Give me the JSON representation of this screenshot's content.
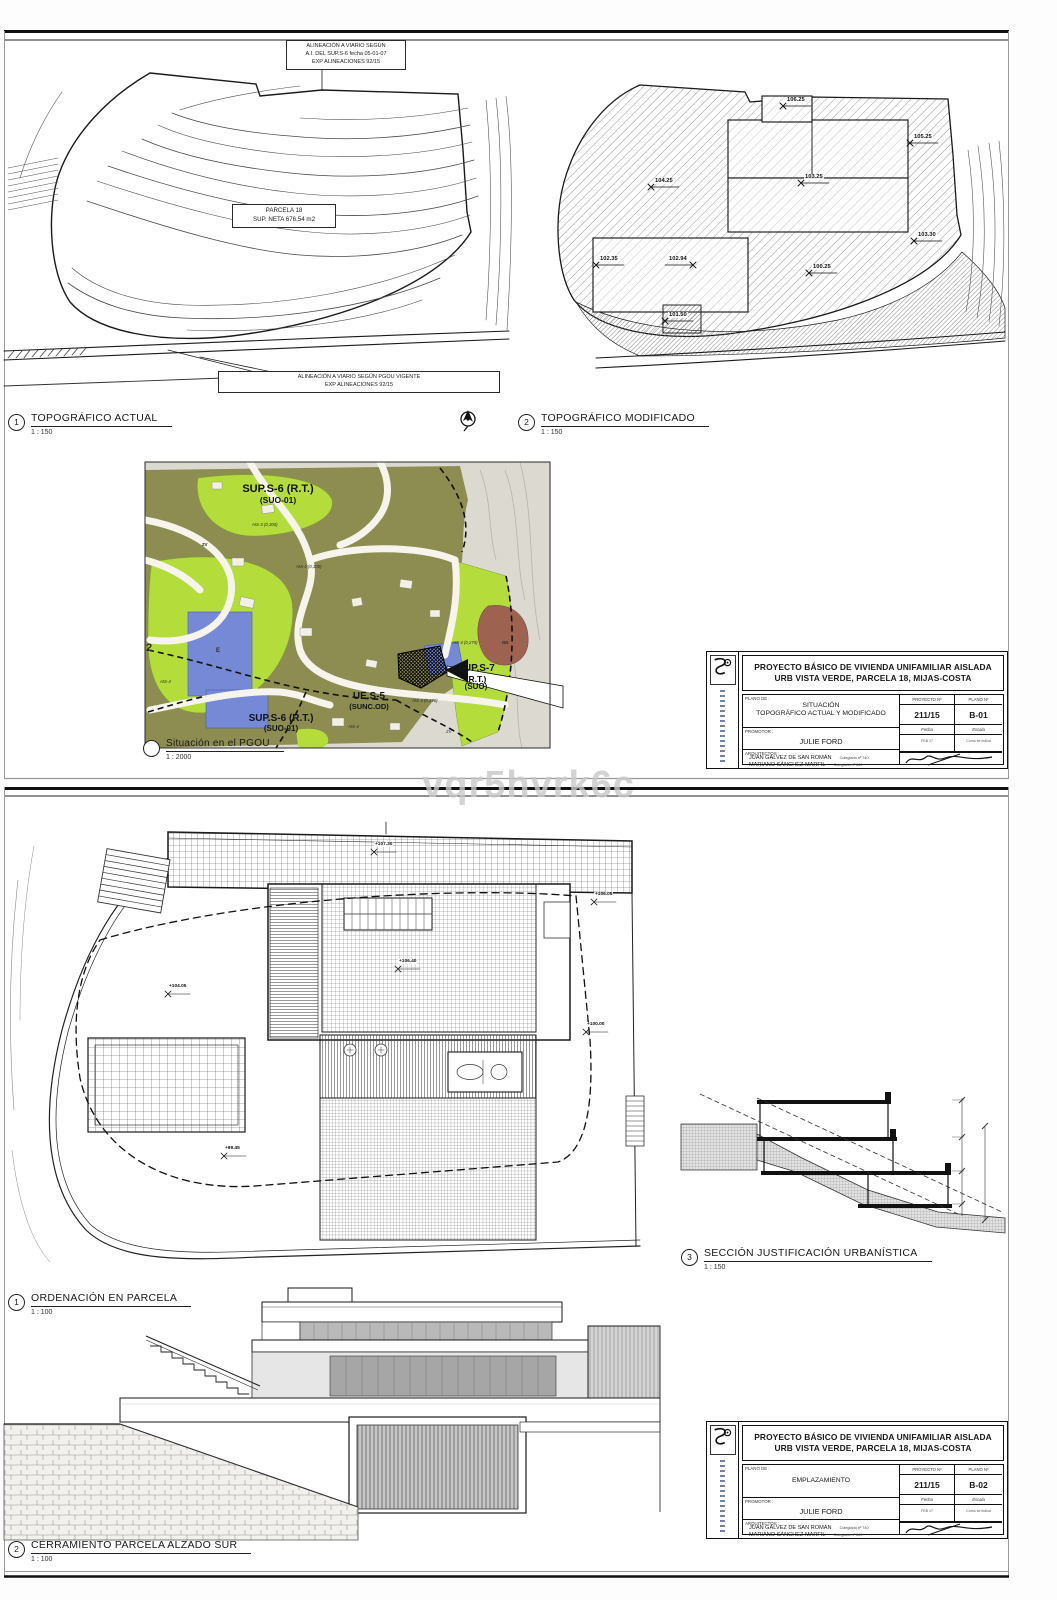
{
  "watermark": "vqr5hvrk6c",
  "common": {
    "project_title_1": "PROYECTO BÁSICO DE VIVIENDA UNIFAMILIAR AISLADA",
    "project_title_2": "URB VISTA VERDE, PARCELA 18, MIJAS-COSTA",
    "labels": {
      "plano_de": "PLANO DE :",
      "proyecto_n": "PROYECTO Nº",
      "plano_n": "PLANO Nº",
      "promotor": "PROMOTOR :",
      "fecha": "Fecha",
      "escala": "Escala",
      "arquitectos": "ARQUITECTOS :"
    },
    "proyecto_n_value": "211/15",
    "promotor_value": "JULIE FORD",
    "fecha_value": "FEB 17",
    "escala_value": "Como se indica",
    "arquitecto_1": "JUAN GÁLVEZ DE SAN ROMÁN",
    "arquitecto_1_col": "Colegiado nº 740",
    "arquitecto_2": "MARIANO SÁNCHEZ MARFIL",
    "arquitecto_2_col": "Colegiado nº 669"
  },
  "sheet1": {
    "titleblock": {
      "plano_value_1": "SITUACIÓN",
      "plano_value_2": "TOPOGRÁFICO ACTUAL Y MODIFICADO",
      "plano_n_value": "B-01"
    },
    "topo_actual": {
      "num": "1",
      "title": "TOPOGRÁFICO ACTUAL",
      "scale": "1 : 150",
      "note_top_1": "ALINEACIÓN A VIARIO SEGÚN",
      "note_top_2": "A.I. DEL SUP.S-6 fecha 05-01-07",
      "note_top_3": "EXP ALINEACIONES 92/15",
      "parcel_1": "PARCELA 18",
      "parcel_2": "SUP. NETA 676,54 m2",
      "note_bottom_1": "ALINEACIÓN A VIARIO SEGÚN PGOU VIGENTE",
      "note_bottom_2": "EXP ALINEACIONES 92/15"
    },
    "topo_mod": {
      "num": "2",
      "title": "TOPOGRÁFICO MODIFICADO",
      "scale": "1 : 150",
      "spots": [
        {
          "v": "106.25"
        },
        {
          "v": "105.25"
        },
        {
          "v": "104.25"
        },
        {
          "v": "103.25"
        },
        {
          "v": "103.30"
        },
        {
          "v": "102.35"
        },
        {
          "v": "102.94"
        },
        {
          "v": "100.25"
        },
        {
          "v": "101.50"
        }
      ]
    },
    "pgou": {
      "num": "",
      "title": "Situación en el PGOU",
      "scale": "1 : 2000",
      "labels": {
        "sup_s6_top_1": "SUP.S-6 (R.T.)",
        "sup_s6_top_2": "(SUO-01)",
        "zv": "ZV",
        "zv2": "ZV",
        "e": "E",
        "corner": "2",
        "ais3_a": "AIS-3 (0,300)",
        "ais3_b": "AIS-3 (0,300)",
        "ais4_a": "AIS-4 (0,275)",
        "ais4_b": "AIS-4 (0,270)",
        "ais4_c": "AIS-4",
        "ais4_d": "AIS-4",
        "od": "OD",
        "ue_s5_1": "UE.S-5",
        "ue_s5_2": "(SUNC.OD)",
        "sup_s7_1": "SUP.S-7",
        "sup_s7_2": "(R.T.)",
        "sup_s7_3": "(SUO)",
        "sup_s6_bot_1": "SUP.S-6 (R.T.)",
        "sup_s6_bot_2": "(SUO-01)"
      }
    }
  },
  "sheet2": {
    "titleblock": {
      "plano_value_1": "EMPLAZAMIENTO",
      "plano_n_value": "B-02"
    },
    "ordenacion": {
      "num": "1",
      "title": "ORDENACIÓN EN PARCELA",
      "scale": "1 : 100",
      "spots": [
        {
          "v": "+107.30"
        },
        {
          "v": "+106.05"
        },
        {
          "v": "+106.40"
        },
        {
          "v": "+104.05"
        },
        {
          "v": "+100.00"
        },
        {
          "v": "+99.45"
        }
      ]
    },
    "seccion": {
      "num": "3",
      "title": "SECCIÓN JUSTIFICACIÓN URBANÍSTICA",
      "scale": "1 : 150"
    },
    "cerramiento": {
      "num": "2",
      "title": "CERRAMIENTO PARCELA ALZADO SUR",
      "scale": "1 : 100"
    }
  }
}
